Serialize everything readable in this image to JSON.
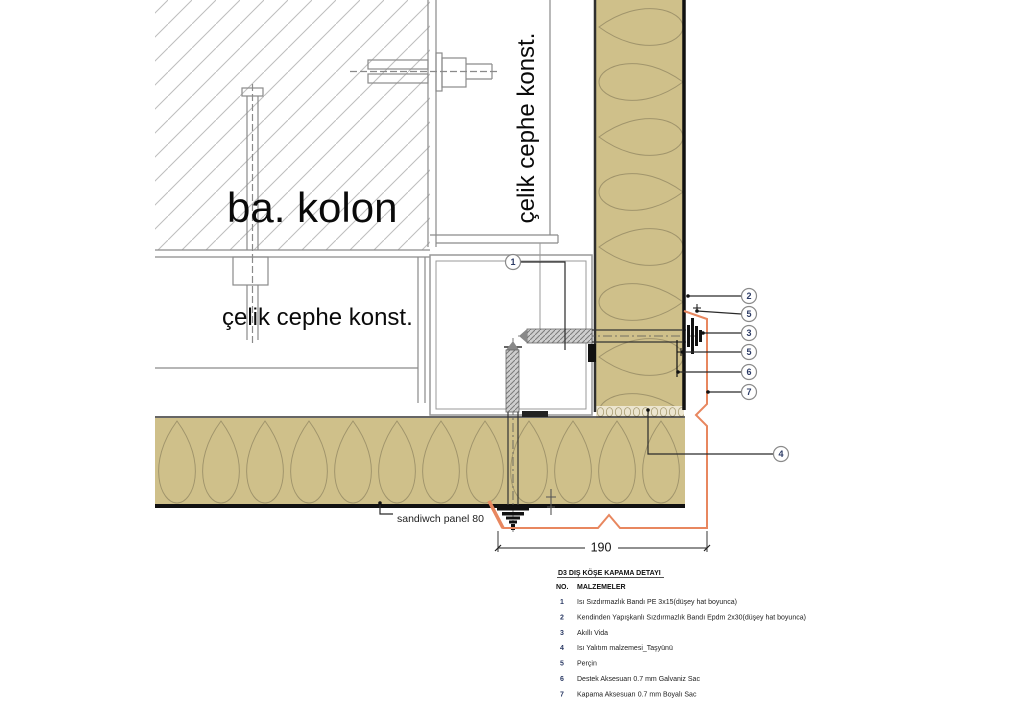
{
  "drawing": {
    "labels": {
      "column": "ba. kolon",
      "facade_vertical": "çelik cephe konst.",
      "facade_horizontal": "çelik cephe konst.",
      "panel_note": "sandiwch panel 80"
    },
    "dimension": {
      "value": "190"
    },
    "callouts": {
      "box": "1",
      "right_column": [
        "2",
        "5",
        "3",
        "5",
        "6",
        "7"
      ],
      "insulation": "4"
    },
    "colors": {
      "insulation_fill": "#cfc08a",
      "insulation_pattern": "#a0946b",
      "closure_sheet_orange": "#e8875f",
      "steel_line_gray": "#8a8a8a",
      "callout_number_navy": "#2b3a64",
      "edge_black": "#111111"
    }
  },
  "legend": {
    "title": "D3 DIŞ KÖŞE KAPAMA DETAYI",
    "columns": {
      "no": "NO.",
      "materials": "MALZEMELER"
    },
    "items": [
      {
        "no": "1",
        "text": "Isı Sızdırmazlık Bandı PE 3x15(düşey hat boyunca)"
      },
      {
        "no": "2",
        "text": "Kendinden Yapışkanlı Sızdırmazlık Bandı Epdm 2x30(düşey hat boyunca)"
      },
      {
        "no": "3",
        "text": "Akıllı Vida"
      },
      {
        "no": "4",
        "text": "Isı Yalıtım malzemesi_Taşyünü"
      },
      {
        "no": "5",
        "text": "Perçin"
      },
      {
        "no": "6",
        "text": "Destek Aksesuarı 0.7 mm Galvaniz Sac"
      },
      {
        "no": "7",
        "text": "Kapama Aksesuarı 0.7 mm Boyalı Sac"
      }
    ]
  }
}
